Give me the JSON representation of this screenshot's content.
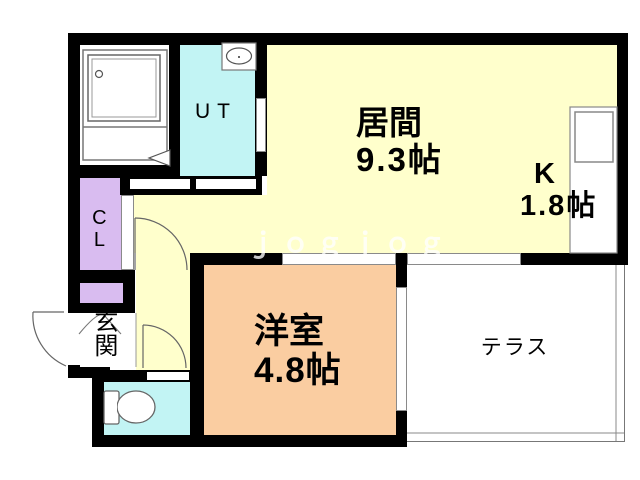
{
  "plan_title": "1K apartment floor plan",
  "palette": {
    "wall": "#000000",
    "living_yellow": "#FFFFCC",
    "water_cyan": "#C2F4F4",
    "closet_purple": "#D9BCF0",
    "western_orange": "#FACDA1",
    "outline_gray": "#777777",
    "watermark_color": "rgba(255,255,255,0.78)"
  },
  "rooms": {
    "living": {
      "name": "居間",
      "size": "9.3帖"
    },
    "kitchen": {
      "name": "K",
      "size": "1.8帖"
    },
    "western": {
      "name": "洋室",
      "size": "4.8帖"
    },
    "terrace": {
      "name": "テラス"
    },
    "utility": {
      "name": "UT"
    },
    "closet": {
      "name": "CL"
    },
    "entrance": {
      "name": "玄関"
    }
  },
  "icons": {
    "bathtub": "bathtub-outline",
    "wash_basin": "oval-basin",
    "kitchen_sink": "square-sink",
    "toilet": "toilet-outline",
    "door_swings": "quarter-arc-door-marks"
  },
  "watermark": "ｊｏｇｊｏｇ"
}
